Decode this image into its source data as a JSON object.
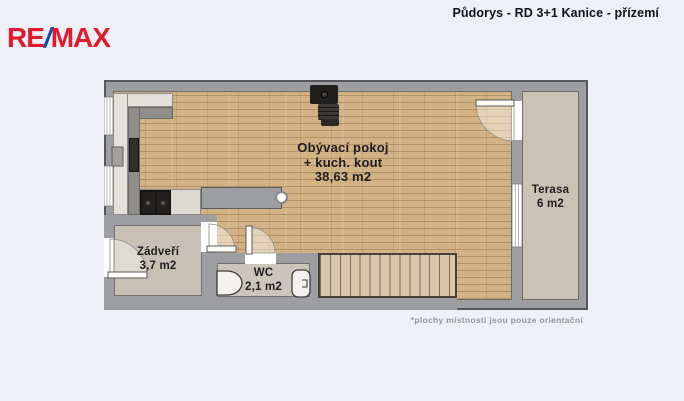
{
  "header": {
    "logo": {
      "part1": "RE",
      "slash": "/",
      "part2": "MAX"
    },
    "title": "Půdorys - RD 3+1 Kanice - přízemí"
  },
  "plan": {
    "rooms": [
      {
        "id": "living-kitchen",
        "name": "Obývací pokoj",
        "name_line2": "+ kuch. kout",
        "area": "38,63 m2"
      },
      {
        "id": "terrace",
        "name": "Terasa",
        "area": "6 m2"
      },
      {
        "id": "entrance-hall",
        "name": "Zádveří",
        "area": "3,7 m2"
      },
      {
        "id": "wc",
        "name": "WC",
        "area": "2,1 m2"
      }
    ],
    "fixtures": [
      "kitchen-counter",
      "fridge",
      "cooktop",
      "wood-stove",
      "staircase",
      "sink",
      "toilet",
      "column",
      "window",
      "door"
    ],
    "colors": {
      "background": "#eef0f6",
      "wall": "#9d9ea2",
      "wood_floor": "#d2b184",
      "terrace_floor": "#cac3b5",
      "hall_floor": "#c7c1b5",
      "wc_floor": "#cbc5bb",
      "stairs": "#d9c5a7",
      "logo_red": "#e11b2d",
      "logo_blue": "#0f4fa8"
    }
  },
  "footer": {
    "note": "*plochy místností jsou pouze orientační"
  }
}
